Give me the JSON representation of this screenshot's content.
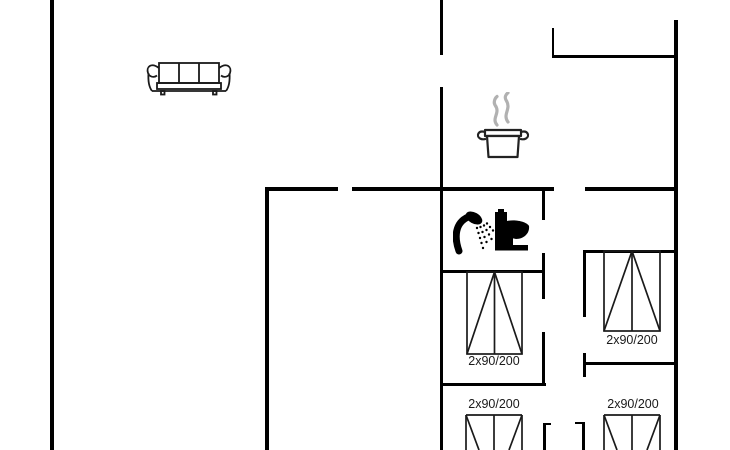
{
  "floorplan": {
    "colors": {
      "wall": "#000000",
      "furniture_line": "#1a1a1a",
      "steam": "#b1b1b1",
      "background": "#ffffff"
    },
    "beds": [
      {
        "label": "2x90/200"
      },
      {
        "label": "2x90/200"
      },
      {
        "label": "2x90/200"
      },
      {
        "label": "2x90/200"
      }
    ],
    "fixtures": [
      "sofa",
      "cooking-pot",
      "shower",
      "toilet"
    ]
  }
}
